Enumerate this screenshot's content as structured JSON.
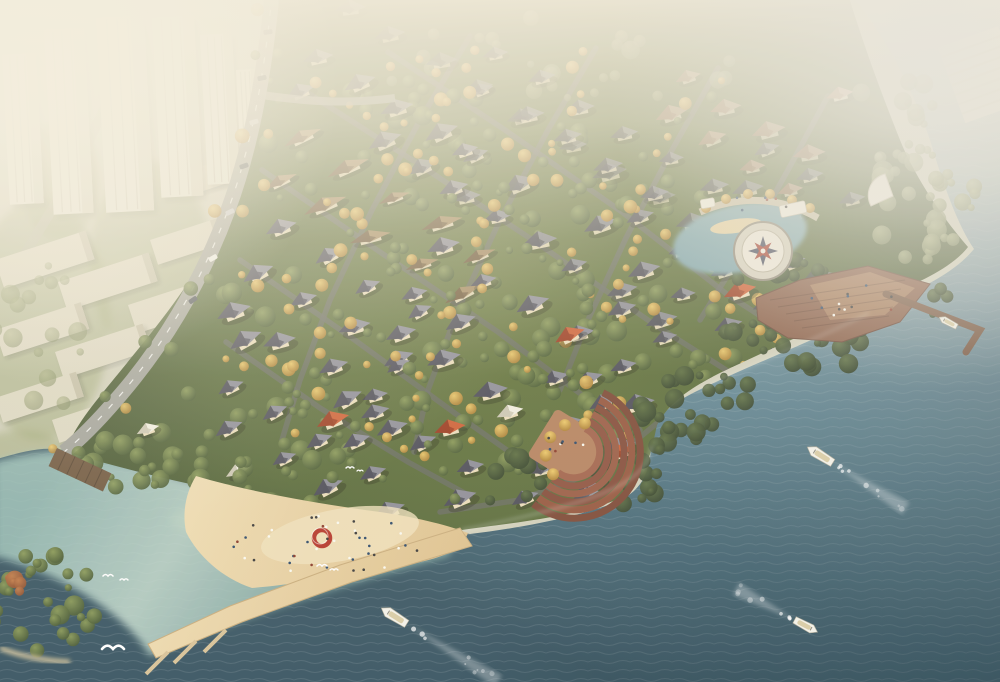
{
  "meta": {
    "title": "Aerial rendering of a riverside villa community with boats on the water"
  },
  "scene": {
    "palette": {
      "landBase": "#d2d1bd",
      "wall": "#ecdfbd",
      "roofs": {
        "dark": [
          "#8e8e99",
          "#4e4e59"
        ],
        "brown": [
          "#a98a5f",
          "#6d5335"
        ],
        "pink": [
          "#d1a28c",
          "#a26e57"
        ],
        "red": [
          "#cf6136",
          "#9c3c20"
        ],
        "white": [
          "#f2efe2",
          "#cdc8b4"
        ]
      },
      "street": "#6b6d66",
      "road": "#a2a39a",
      "deck": "#8a5f49",
      "pier": "#7a5a45",
      "terrace": [
        "#a2644c",
        "#8e5340",
        "#9a5c45",
        "#854d3a",
        "#96573f",
        "#7d4936"
      ],
      "terracePlaza": "#b5835f",
      "sandLight": "#f0e2bd",
      "embankment": "#70583f",
      "redRing": "#b5372a",
      "compassStarRed": "#a33b2c",
      "compassStarDark": "#41465a",
      "waterStops": [
        "#c6d5d6",
        "#9cb8c0",
        "#6d93a0",
        "#4c707e",
        "#3a5764"
      ],
      "lagoonStops": [
        "#c7ded1",
        "#9ec4bb"
      ],
      "sandStops": [
        "#eedcb2",
        "#dfc28e"
      ]
    },
    "paths": {
      "water": "M -6 460 C 20 452 42 446 64 450 C 100 457 160 476 212 489 C 282 507 362 517 470 534 C 522 528 580 516 614 503 C 642 492 650 472 651 446 C 652 422 664 407 697 391 C 748 366 818 339 869 313 C 914 291 952 276 974 249 C 958 225 945 190 930 140 C 910 80 880 30 851 -6 L 1006 -6 L 1006 688 L -6 688 Z",
      "lagoon": "M -6 462 C 30 452 60 448 86 454 C 130 463 190 481 245 495 C 310 510 390 520 460 532 L 448 556 C 380 574 300 598 225 626 C 188 640 162 650 150 656 C 128 616 64 574 -6 556 Z",
      "community": "M 258 70 C 266 28 270 2 272 -6 L 848 -6 C 862 40 880 90 900 140 C 912 170 936 210 968 247 C 950 270 914 284 879 300 C 829 323 779 345 724 371 C 689 388 669 403 657 425 C 651 452 648 478 616 500 C 570 518 502 524 462 530 C 400 519 330 509 250 496 C 188 485 120 468 66 452 C 72 430 90 408 118 374 C 152 332 188 290 214 238 C 236 192 250 128 258 70 Z",
      "beach": "M 196 476 C 250 492 320 504 380 512 C 420 518 450 526 468 533 C 462 548 448 556 420 562 C 370 572 300 584 252 588 C 222 578 198 556 186 532 C 182 512 186 492 196 476 Z",
      "causeway": "M 460 528 L 472 546 L 352 582 L 242 622 L 156 658 L 148 644 L 230 606 L 340 565 Z",
      "deckPlatform": "M 756 298 L 800 280 L 868 266 L 930 284 L 900 322 L 842 342 L 788 338 L 758 320 Z",
      "deckInner": "M 810 285 L 870 272 L 915 288 L 885 315 L 830 320 Z",
      "mainRoad": "M 272 -6 C 266 60 254 140 228 210 C 200 286 160 350 116 400 C 92 428 74 444 64 452",
      "sideRoad": "M 262 95 C 310 102 350 104 395 98",
      "walkwayArc": "M 700 212 Q 760 186 818 218",
      "shoreFoam1": "M 651 446 C 648 478 616 500 462 530",
      "shoreFoam2": "M 697 391 C 748 366 818 339 869 313"
    },
    "towers": [
      [
        2,
        55,
        34,
        150
      ],
      [
        44,
        30,
        40,
        185
      ],
      [
        96,
        18,
        48,
        195
      ],
      [
        152,
        18,
        42,
        180
      ],
      [
        200,
        35,
        32,
        150
      ],
      [
        236,
        70,
        20,
        110
      ]
    ],
    "slabs": [
      [
        -5,
        260,
        95,
        30
      ],
      [
        58,
        282,
        95,
        30
      ],
      [
        128,
        305,
        95,
        30
      ],
      [
        -5,
        330,
        90,
        28
      ],
      [
        55,
        352,
        92,
        28
      ],
      [
        120,
        375,
        92,
        28
      ],
      [
        -5,
        398,
        85,
        26
      ],
      [
        52,
        420,
        80,
        24
      ],
      [
        150,
        240,
        70,
        26
      ],
      [
        190,
        170,
        60,
        24
      ],
      [
        100,
        418,
        48,
        22
      ]
    ],
    "cityGreens": [
      [
        40,
        320,
        70,
        120
      ],
      [
        150,
        260,
        60,
        100
      ],
      [
        240,
        420,
        80,
        60
      ],
      [
        60,
        180,
        40,
        60
      ],
      [
        20,
        470,
        60,
        40
      ]
    ],
    "streets": [
      [
        [
          300,
          88
        ],
        [
          420,
          165
        ],
        [
          540,
          245
        ],
        [
          655,
          325
        ],
        [
          745,
          382
        ]
      ],
      [
        [
          388,
          52
        ],
        [
          505,
          130
        ],
        [
          622,
          212
        ],
        [
          728,
          295
        ],
        [
          790,
          335
        ]
      ],
      [
        [
          262,
          170
        ],
        [
          380,
          252
        ],
        [
          498,
          332
        ],
        [
          586,
          398
        ],
        [
          640,
          430
        ]
      ],
      [
        [
          240,
          260
        ],
        [
          352,
          338
        ],
        [
          456,
          414
        ],
        [
          532,
          468
        ]
      ],
      [
        [
          226,
          342
        ],
        [
          320,
          408
        ],
        [
          408,
          462
        ],
        [
          470,
          496
        ]
      ],
      [
        [
          470,
          36
        ],
        [
          420,
          120
        ],
        [
          372,
          210
        ],
        [
          330,
          300
        ],
        [
          300,
          380
        ],
        [
          282,
          440
        ]
      ],
      [
        [
          596,
          48
        ],
        [
          548,
          130
        ],
        [
          500,
          220
        ],
        [
          458,
          310
        ],
        [
          428,
          390
        ],
        [
          414,
          452
        ]
      ],
      [
        [
          718,
          68
        ],
        [
          672,
          150
        ],
        [
          626,
          238
        ],
        [
          588,
          320
        ],
        [
          560,
          390
        ]
      ],
      [
        [
          828,
          96
        ],
        [
          788,
          170
        ],
        [
          742,
          252
        ],
        [
          700,
          320
        ]
      ],
      [
        [
          656,
          424
        ],
        [
          600,
          470
        ],
        [
          520,
          500
        ],
        [
          440,
          512
        ]
      ]
    ],
    "houseClusters": [
      {
        "x": 350,
        "y": 8,
        "cols": 8,
        "rows": 1,
        "dx": 44,
        "dy": 36,
        "rot": -12,
        "roof": "dark",
        "op": 0.6,
        "seed": 11
      },
      {
        "x": 320,
        "y": 60,
        "cols": 6,
        "rows": 2,
        "dx": 40,
        "dy": 36,
        "rot": -18,
        "roof": "dark",
        "op": 0.8,
        "seed": 2
      },
      {
        "x": 500,
        "y": 55,
        "cols": 6,
        "rows": 2,
        "dx": 42,
        "dy": 34,
        "rot": -15,
        "roof": "dark",
        "op": 0.72,
        "seed": 3
      },
      {
        "x": 690,
        "y": 80,
        "cols": 4,
        "rows": 2,
        "dx": 40,
        "dy": 36,
        "rot": -15,
        "roof": "pink",
        "op": 0.65,
        "seed": 4
      },
      {
        "x": 300,
        "y": 140,
        "cols": 5,
        "rows": 2,
        "dx": 46,
        "dy": 38,
        "rot": -20,
        "roof": "brown",
        "op": 0.92,
        "seed": 5,
        "aspect": 1.6,
        "s": 12
      },
      {
        "x": 470,
        "y": 150,
        "cols": 6,
        "rows": 2,
        "dx": 42,
        "dy": 38,
        "rot": -18,
        "roof": "dark",
        "op": 0.9,
        "seed": 6
      },
      {
        "x": 660,
        "y": 180,
        "cols": 4,
        "rows": 2,
        "dx": 44,
        "dy": 40,
        "rot": -18,
        "roof": "dark",
        "op": 0.85,
        "seed": 7
      },
      {
        "x": 280,
        "y": 230,
        "cols": 4,
        "rows": 3,
        "dx": 46,
        "dy": 42,
        "rot": -22,
        "roof": "dark",
        "op": 1,
        "seed": 8
      },
      {
        "x": 440,
        "y": 250,
        "cols": 5,
        "rows": 3,
        "dx": 46,
        "dy": 42,
        "rot": -20,
        "roof": "dark",
        "op": 1,
        "seed": 9
      },
      {
        "x": 640,
        "y": 270,
        "cols": 4,
        "rows": 2,
        "dx": 46,
        "dy": 40,
        "rot": -18,
        "roof": "dark",
        "op": 0.95,
        "seed": 10
      },
      {
        "x": 250,
        "y": 340,
        "cols": 4,
        "rows": 2,
        "dx": 48,
        "dy": 44,
        "rot": -24,
        "roof": "dark",
        "op": 1,
        "seed": 12
      },
      {
        "x": 400,
        "y": 370,
        "cols": 5,
        "rows": 2,
        "dx": 48,
        "dy": 42,
        "rot": -22,
        "roof": "dark",
        "op": 1,
        "seed": 13
      },
      {
        "x": 590,
        "y": 380,
        "cols": 3,
        "rows": 2,
        "dx": 46,
        "dy": 40,
        "rot": -20,
        "roof": "dark",
        "op": 1,
        "seed": 14
      },
      {
        "x": 230,
        "y": 430,
        "cols": 3,
        "rows": 1,
        "dx": 50,
        "dy": 44,
        "rot": -24,
        "roof": "dark",
        "op": 1,
        "seed": 15
      },
      {
        "x": 360,
        "y": 440,
        "cols": 3,
        "rows": 2,
        "dx": 50,
        "dy": 40,
        "rot": -22,
        "roof": "dark",
        "op": 1,
        "seed": 16
      },
      {
        "x": 770,
        "y": 150,
        "cols": 3,
        "rows": 3,
        "dx": 42,
        "dy": 40,
        "rot": -16,
        "roof": "dark",
        "op": 0.68,
        "seed": 17
      },
      {
        "x": 540,
        "y": 470,
        "cols": 3,
        "rows": 1,
        "dx": 44,
        "dy": 40,
        "rot": -18,
        "roof": "dark",
        "op": 0.95,
        "seed": 18
      }
    ],
    "houseSingles": [
      {
        "x": 333,
        "y": 421,
        "s": 17,
        "rot": -20,
        "roof": "red"
      },
      {
        "x": 450,
        "y": 429,
        "s": 16,
        "rot": -14,
        "roof": "red"
      },
      {
        "x": 570,
        "y": 336,
        "s": 16,
        "rot": -24,
        "roof": "red"
      },
      {
        "x": 740,
        "y": 292,
        "s": 17,
        "rot": -18,
        "roof": "red"
      },
      {
        "x": 798,
        "y": 306,
        "s": 15,
        "rot": -10,
        "roof": "red"
      },
      {
        "x": 620,
        "y": 453,
        "s": 15,
        "rot": -20,
        "roof": "red"
      },
      {
        "x": 840,
        "y": 95,
        "s": 14,
        "rot": -14,
        "roof": "pink"
      },
      {
        "x": 510,
        "y": 413,
        "s": 14,
        "rot": -18,
        "roof": "white"
      },
      {
        "x": 238,
        "y": 472,
        "s": 13,
        "rot": -22,
        "roof": "white"
      },
      {
        "x": 148,
        "y": 430,
        "s": 12,
        "rot": -20,
        "roof": "white"
      }
    ],
    "treeClusters": [
      {
        "cx": 350,
        "cy": 120,
        "rx": 160,
        "ry": 50,
        "n": 25,
        "type": "g",
        "seed": 21
      },
      {
        "cx": 550,
        "cy": 180,
        "rx": 180,
        "ry": 60,
        "n": 25,
        "type": "g",
        "seed": 22
      },
      {
        "cx": 420,
        "cy": 300,
        "rx": 200,
        "ry": 70,
        "n": 30,
        "type": "g",
        "seed": 23
      },
      {
        "cx": 620,
        "cy": 340,
        "rx": 140,
        "ry": 50,
        "n": 20,
        "type": "g",
        "seed": 24
      },
      {
        "cx": 300,
        "cy": 420,
        "rx": 150,
        "ry": 50,
        "n": 22,
        "type": "g",
        "seed": 25
      },
      {
        "cx": 520,
        "cy": 430,
        "rx": 120,
        "ry": 40,
        "n": 18,
        "type": "g",
        "seed": 26
      },
      {
        "cx": 560,
        "cy": 60,
        "rx": 220,
        "ry": 45,
        "n": 26,
        "type": "m",
        "seed": 27,
        "op": 0.6
      },
      {
        "cx": 560,
        "cy": 480,
        "rx": 110,
        "ry": 30,
        "n": 26,
        "type": "d",
        "seed": 31
      },
      {
        "cx": 700,
        "cy": 400,
        "rx": 60,
        "ry": 30,
        "n": 18,
        "type": "d",
        "seed": 32
      },
      {
        "cx": 800,
        "cy": 340,
        "rx": 90,
        "ry": 30,
        "n": 26,
        "type": "d",
        "seed": 33
      },
      {
        "cx": 890,
        "cy": 300,
        "rx": 60,
        "ry": 22,
        "n": 14,
        "type": "d",
        "seed": 34
      },
      {
        "cx": 920,
        "cy": 200,
        "rx": 60,
        "ry": 60,
        "n": 30,
        "type": "m",
        "seed": 35,
        "op": 0.85
      },
      {
        "cx": 895,
        "cy": 120,
        "rx": 40,
        "ry": 55,
        "n": 18,
        "type": "m",
        "seed": 36,
        "op": 0.7
      },
      {
        "cx": 250,
        "cy": 480,
        "rx": 140,
        "ry": 26,
        "n": 26,
        "type": "g",
        "seed": 37
      },
      {
        "cx": 120,
        "cy": 460,
        "rx": 70,
        "ry": 20,
        "n": 14,
        "type": "g",
        "seed": 38
      },
      {
        "cx": 45,
        "cy": 605,
        "rx": 55,
        "ry": 52,
        "n": 26,
        "type": "g",
        "seed": 39
      },
      {
        "cx": 18,
        "cy": 586,
        "rx": 16,
        "ry": 12,
        "n": 5,
        "type": "r",
        "seed": 40
      },
      {
        "cx": 770,
        "cy": 268,
        "rx": 60,
        "ry": 14,
        "n": 14,
        "type": "d",
        "seed": 41
      },
      {
        "cx": 40,
        "cy": 330,
        "rx": 55,
        "ry": 90,
        "n": 16,
        "type": "m",
        "seed": 42,
        "op": 0.55
      },
      {
        "cx": 660,
        "cy": 430,
        "rx": 40,
        "ry": 26,
        "n": 12,
        "type": "d",
        "seed": 43
      }
    ],
    "roadTreePts": [
      [
        272,
        0
      ],
      [
        266,
        60
      ],
      [
        254,
        140
      ],
      [
        228,
        210
      ],
      [
        200,
        286
      ],
      [
        160,
        350
      ],
      [
        116,
        400
      ],
      [
        64,
        452
      ]
    ],
    "landmarks": {
      "compass": {
        "cx": 763,
        "cy": 251,
        "rOuter": 29,
        "rRing": 21,
        "rStar": 15
      },
      "inlet": {
        "cx": 740,
        "cy": 238,
        "rx": 68,
        "ry": 34,
        "rot": -12
      },
      "inletBeach": {
        "cx": 736,
        "cy": 226,
        "rx": 26,
        "ry": 7,
        "rot": -8
      },
      "pavilion1": {
        "x": 779,
        "y": 206,
        "w": 26,
        "h": 12,
        "rot": -12
      },
      "pavilion2": {
        "x": 700,
        "y": 200,
        "w": 14,
        "h": 9,
        "rot": -10
      },
      "terrace": {
        "cx": 574,
        "cy": 452,
        "rot": 32,
        "radii": [
          26,
          34,
          42,
          50,
          58,
          66
        ]
      },
      "fanBuilding": {
        "cx": 893,
        "cy": 196,
        "r": 22
      },
      "marina": {
        "x": 938,
        "y": 48,
        "w": 64,
        "h": 80,
        "rot": -20,
        "lines": 7
      },
      "pier": {
        "pts": [
          [
            886,
            294
          ],
          [
            980,
            330
          ],
          [
            966,
            352
          ]
        ]
      },
      "embankment": {
        "x": 57,
        "y": 448,
        "w": 60,
        "h": 20,
        "rot": 25
      },
      "redRing": {
        "cx": 322,
        "cy": 538,
        "r": 8
      },
      "docks": [
        [
          196,
          641
        ],
        [
          226,
          630
        ],
        [
          168,
          652
        ]
      ],
      "islandBeach": "M 0 648 Q 30 660 70 662"
    },
    "cars": [
      [
        268,
        32,
        -8
      ],
      [
        262,
        78,
        -12
      ],
      [
        254,
        122,
        -16
      ],
      [
        244,
        166,
        -20
      ],
      [
        230,
        212,
        -26
      ],
      [
        213,
        258,
        -30
      ],
      [
        193,
        300,
        -35
      ]
    ],
    "boats": [
      {
        "x": 820,
        "y": 455,
        "rot": 212,
        "len": 30,
        "wakeLen": 86,
        "seed": 51
      },
      {
        "x": 394,
        "y": 616,
        "rot": 212,
        "len": 30,
        "wakeLen": 108,
        "seed": 52
      },
      {
        "x": 806,
        "y": 626,
        "rot": 28,
        "len": 26,
        "wakeLen": 66,
        "seed": 53
      },
      {
        "x": 948,
        "y": 322,
        "rot": 208,
        "len": 20,
        "wakeLen": 0,
        "seed": 54
      }
    ],
    "gulls": [
      [
        113,
        649,
        11
      ],
      [
        108,
        576,
        5
      ],
      [
        124,
        580,
        4
      ],
      [
        322,
        566,
        5
      ],
      [
        334,
        570,
        4
      ],
      [
        350,
        468,
        4
      ],
      [
        360,
        471,
        3
      ]
    ],
    "peopleGroups": [
      {
        "cx": 330,
        "cy": 545,
        "rx": 105,
        "ry": 30,
        "n": 42,
        "seed": 61
      },
      {
        "cx": 848,
        "cy": 302,
        "rx": 48,
        "ry": 18,
        "n": 12,
        "seed": 62
      },
      {
        "cx": 560,
        "cy": 440,
        "rx": 26,
        "ry": 14,
        "n": 8,
        "seed": 63
      },
      {
        "cx": 758,
        "cy": 203,
        "rx": 48,
        "ry": 8,
        "n": 6,
        "seed": 64
      }
    ]
  }
}
